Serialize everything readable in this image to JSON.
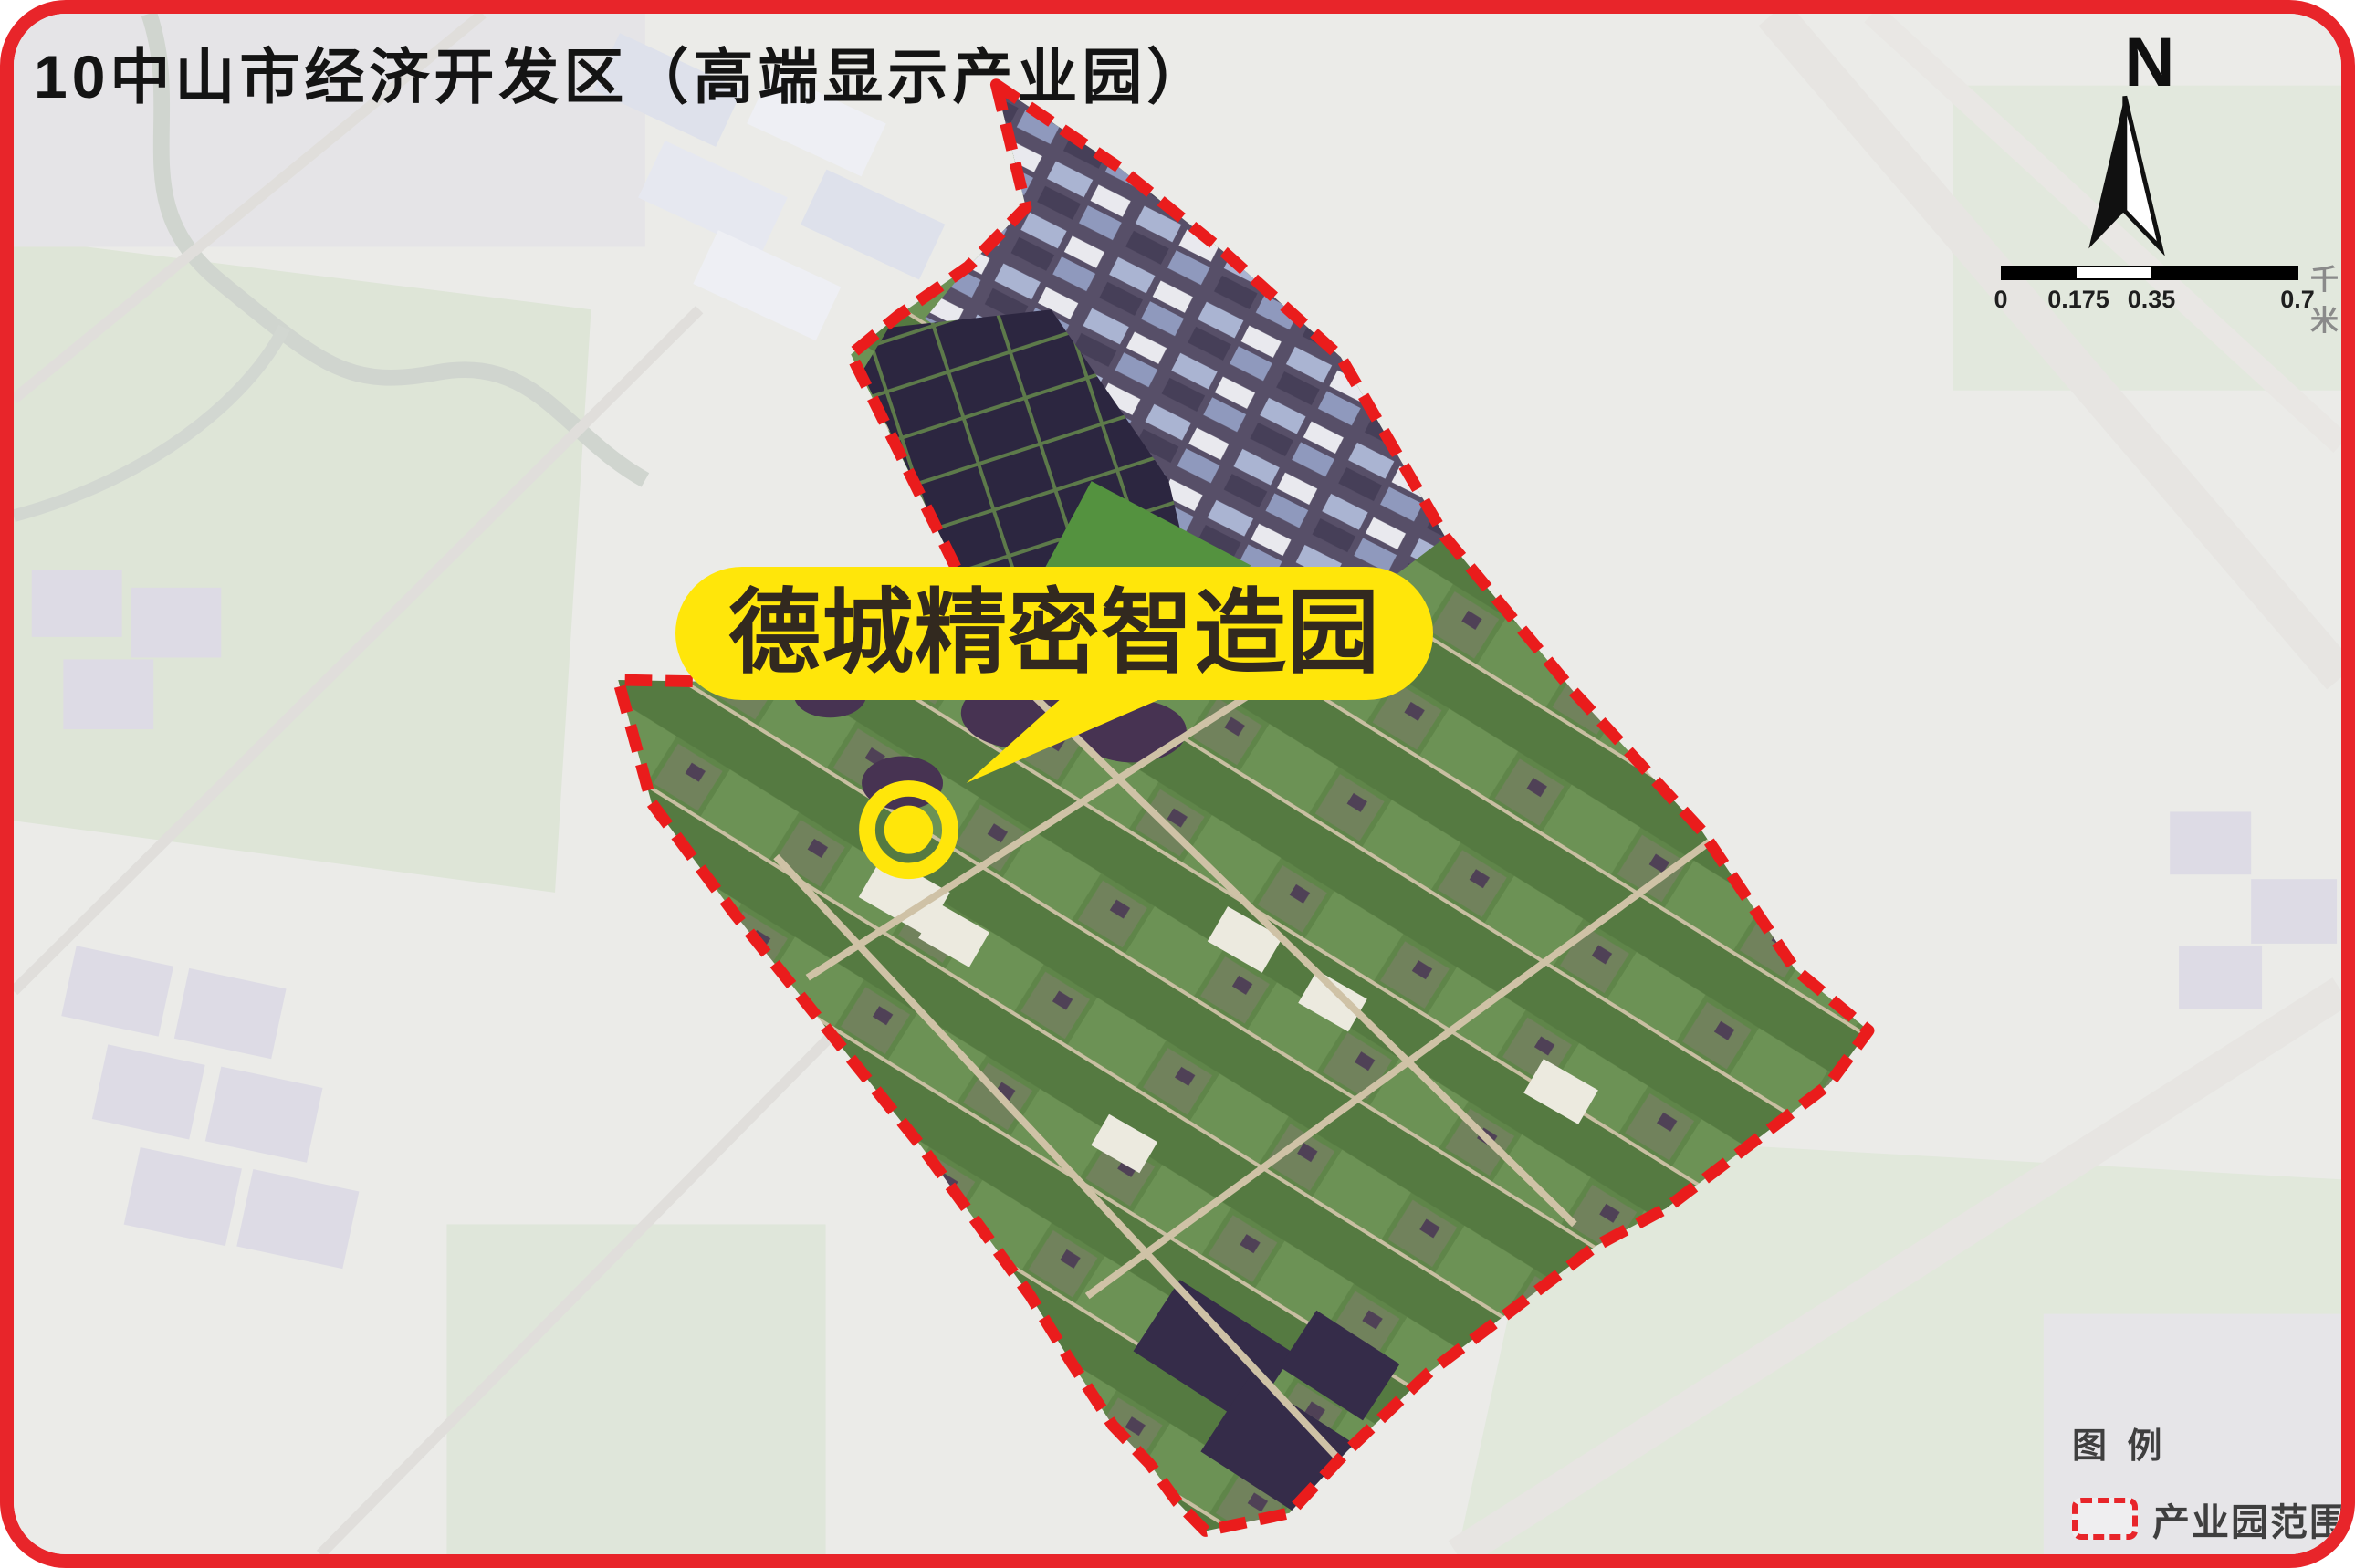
{
  "title": "10中山市经济开发区（高端显示产业园）",
  "callout": {
    "label": "德城精密智造园"
  },
  "compass": {
    "label": "N"
  },
  "scale_bar": {
    "ticks": [
      "0",
      "0.175",
      "0.35",
      "0.7"
    ],
    "unit": "千米"
  },
  "legend": {
    "title": "图 例",
    "items": [
      {
        "label": "产业园范围",
        "swatch": "red-dashed-outline"
      }
    ]
  },
  "colors": {
    "frame_red": "#e8252a",
    "boundary_red": "#ea1c1c",
    "callout_yellow": "#ffe60a",
    "callout_text": "#32291f",
    "title_color": "#141414",
    "legend_text": "#3f3f3f",
    "scale_text": "#1f1f1f",
    "unit_text": "#8a8a8a",
    "compass_black": "#101010"
  }
}
